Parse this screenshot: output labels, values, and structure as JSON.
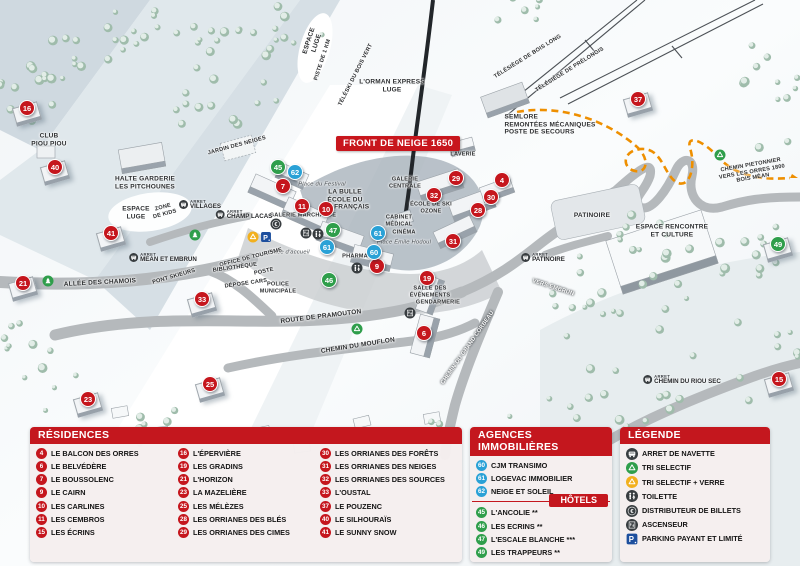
{
  "map": {
    "banner": "FRONT DE NEIGE 1650",
    "bus_prefix": "ARRET",
    "marker_colors": {
      "residence": "#c5161d",
      "hotel": "#2f9e4b",
      "agency": "#2aa1d6"
    },
    "markers": [
      {
        "n": 16,
        "type": "residence",
        "x": 27,
        "y": 108,
        "b": 1
      },
      {
        "n": 40,
        "type": "residence",
        "x": 55,
        "y": 167,
        "b": 1
      },
      {
        "n": 41,
        "type": "residence",
        "x": 111,
        "y": 233,
        "b": 1
      },
      {
        "n": 21,
        "type": "residence",
        "x": 23,
        "y": 283,
        "b": 1
      },
      {
        "n": 33,
        "type": "residence",
        "x": 202,
        "y": 299,
        "b": 1
      },
      {
        "n": 23,
        "type": "residence",
        "x": 88,
        "y": 399,
        "b": 1
      },
      {
        "n": 25,
        "type": "residence",
        "x": 210,
        "y": 384,
        "b": 1
      },
      {
        "n": 7,
        "type": "residence",
        "x": 283,
        "y": 186
      },
      {
        "n": 11,
        "type": "residence",
        "x": 302,
        "y": 206
      },
      {
        "n": 10,
        "type": "residence",
        "x": 326,
        "y": 209
      },
      {
        "n": 9,
        "type": "residence",
        "x": 377,
        "y": 266
      },
      {
        "n": 32,
        "type": "residence",
        "x": 434,
        "y": 195
      },
      {
        "n": 29,
        "type": "residence",
        "x": 456,
        "y": 178
      },
      {
        "n": 4,
        "type": "residence",
        "x": 502,
        "y": 180
      },
      {
        "n": 30,
        "type": "residence",
        "x": 491,
        "y": 197
      },
      {
        "n": 28,
        "type": "residence",
        "x": 478,
        "y": 210
      },
      {
        "n": 31,
        "type": "residence",
        "x": 453,
        "y": 241
      },
      {
        "n": 19,
        "type": "residence",
        "x": 427,
        "y": 278
      },
      {
        "n": 6,
        "type": "residence",
        "x": 424,
        "y": 333
      },
      {
        "n": 37,
        "type": "residence",
        "x": 638,
        "y": 99,
        "b": 1
      },
      {
        "n": 15,
        "type": "residence",
        "x": 779,
        "y": 379,
        "b": 1
      },
      {
        "n": 45,
        "type": "hotel",
        "x": 278,
        "y": 167
      },
      {
        "n": 46,
        "type": "hotel",
        "x": 329,
        "y": 280
      },
      {
        "n": 47,
        "type": "hotel",
        "x": 333,
        "y": 230
      },
      {
        "n": 49,
        "type": "hotel",
        "x": 778,
        "y": 244,
        "b": 1
      },
      {
        "n": 60,
        "type": "agency",
        "x": 374,
        "y": 252
      },
      {
        "n": 61,
        "type": "agency",
        "x": 378,
        "y": 233
      },
      {
        "n": 61,
        "type": "agency",
        "x": 327,
        "y": 247
      },
      {
        "n": 62,
        "type": "agency",
        "x": 295,
        "y": 172
      }
    ],
    "labels": [
      {
        "t": "ESPACE\nLUGE",
        "x": 313,
        "y": 42,
        "r": -72
      },
      {
        "t": "PISTE DE 1 KM",
        "x": 323,
        "y": 60,
        "r": -72,
        "cls": "micro"
      },
      {
        "t": "TÉLÉSKI DU BOIS VERT",
        "x": 356,
        "y": 75,
        "r": -63,
        "cls": "micro"
      },
      {
        "t": "L'ORMAN EXPRESS\nLUGE",
        "x": 392,
        "y": 86
      },
      {
        "t": "TÉLÉSIÈGE DE BOIS LONG",
        "x": 528,
        "y": 57,
        "r": -32,
        "cls": "micro"
      },
      {
        "t": "TÉLÉSIÈGE DE PRÉLONGIS",
        "x": 570,
        "y": 70,
        "r": -32,
        "cls": "micro"
      },
      {
        "t": "SEMLORE\nREMONTÉES MÉCANIQUES\nPOSTE DE SECOURS",
        "x": 550,
        "y": 125,
        "cls": "left"
      },
      {
        "t": "CLUB\nPIOU PIOU",
        "x": 49,
        "y": 140
      },
      {
        "t": "JARDIN DES NEIGES",
        "x": 237,
        "y": 146,
        "r": -15,
        "cls": "micro"
      },
      {
        "t": "HALTE GARDERIE\nLES PITCHOUNES",
        "x": 145,
        "y": 183
      },
      {
        "t": "ESPACE\nLUGE",
        "x": 136,
        "y": 213
      },
      {
        "t": "ZONE\nDE KIDS",
        "x": 164,
        "y": 211,
        "r": -15,
        "cls": "micro"
      },
      {
        "t": "ALLÉE DES CHAMOIS",
        "x": 100,
        "y": 283,
        "r": -3
      },
      {
        "t": "PONT SKIEURS",
        "x": 174,
        "y": 277,
        "r": -16,
        "cls": "micro"
      },
      {
        "t": "DÉPOSE CARS",
        "x": 246,
        "y": 284,
        "r": -8,
        "cls": "micro"
      },
      {
        "t": "ROUTE DE PRAMOUTON",
        "x": 321,
        "y": 317,
        "r": -7
      },
      {
        "t": "CHEMIN DU MOUFLON",
        "x": 358,
        "y": 346,
        "r": -9
      },
      {
        "t": "CHEMIN DU GRAND CORBEAU",
        "x": 468,
        "y": 348,
        "r": -55,
        "cls": "white micro"
      },
      {
        "t": "VERS EMBRUN",
        "x": 553,
        "y": 288,
        "r": 18,
        "cls": "white micro"
      },
      {
        "t": "CHEMIN PIETONNIER\nVERS LES ORRES 1800\nBOIS MÉAN",
        "x": 752,
        "y": 172,
        "r": -10,
        "cls": "micro"
      },
      {
        "t": "ESPACE RENCONTRE\nET CULTURE",
        "x": 672,
        "y": 231
      },
      {
        "t": "PATINOIRE",
        "x": 592,
        "y": 216
      },
      {
        "t": "LA BULLE\nÉCOLE DU\nSKI FRANÇAIS",
        "x": 345,
        "y": 200
      },
      {
        "t": "Place du Festival",
        "x": 322,
        "y": 185,
        "cls": "it"
      },
      {
        "t": "GALERIE MARCHANDE",
        "x": 303,
        "y": 216,
        "cls": "micro"
      },
      {
        "t": "GALERIE\nCENTRALE",
        "x": 405,
        "y": 183,
        "cls": "micro"
      },
      {
        "t": "LAVERIE",
        "x": 463,
        "y": 155,
        "cls": "micro"
      },
      {
        "t": "ÉCOLE DE SKI\nOZONE",
        "x": 431,
        "y": 208,
        "cls": "micro"
      },
      {
        "t": "CABINET\nMÉDICAL",
        "x": 399,
        "y": 221,
        "cls": "micro"
      },
      {
        "t": "CINÉMA",
        "x": 404,
        "y": 233,
        "cls": "micro"
      },
      {
        "t": "Place Émile Hodoul",
        "x": 404,
        "y": 243,
        "cls": "it"
      },
      {
        "t": "PHARMACIE",
        "x": 360,
        "y": 257,
        "cls": "micro"
      },
      {
        "t": "Place d'accueil",
        "x": 289,
        "y": 253,
        "cls": "it"
      },
      {
        "t": "OFFICE DE TOURISME",
        "x": 251,
        "y": 258,
        "r": -14,
        "cls": "micro"
      },
      {
        "t": "BIBLIOTHÈQUE",
        "x": 235,
        "y": 268,
        "r": -8,
        "cls": "micro"
      },
      {
        "t": "POSTE",
        "x": 264,
        "y": 272,
        "r": -12,
        "cls": "micro"
      },
      {
        "t": "POLICE\nMUNICIPALE",
        "x": 278,
        "y": 288,
        "cls": "micro"
      },
      {
        "t": "SALLE DES\nÉVÈNEMENTS",
        "x": 430,
        "y": 292,
        "cls": "micro"
      },
      {
        "t": "GENDARMERIE",
        "x": 438,
        "y": 303,
        "cls": "micro"
      }
    ],
    "bus_stops": [
      {
        "name": "VILLAGES",
        "x": 200,
        "y": 205
      },
      {
        "name": "CHAMP LACAS",
        "x": 244,
        "y": 215
      },
      {
        "name": "MEAN ET EMBRUN",
        "x": 163,
        "y": 258
      },
      {
        "name": "PATINOIRE",
        "x": 543,
        "y": 258
      },
      {
        "name": "CHEMIN DU RIOU SEC",
        "x": 682,
        "y": 380
      }
    ],
    "icons": [
      {
        "k": "tree",
        "x": 48,
        "y": 281
      },
      {
        "k": "tree",
        "x": 195,
        "y": 235
      },
      {
        "k": "recycle-green",
        "x": 357,
        "y": 329
      },
      {
        "k": "recycle-green",
        "x": 720,
        "y": 155
      },
      {
        "k": "recycle-yellow",
        "x": 253,
        "y": 237
      },
      {
        "k": "parking",
        "x": 266,
        "y": 237
      },
      {
        "k": "atm",
        "x": 276,
        "y": 224
      },
      {
        "k": "elevator",
        "x": 306,
        "y": 233
      },
      {
        "k": "toilet",
        "x": 318,
        "y": 234
      },
      {
        "k": "toilet",
        "x": 357,
        "y": 268
      },
      {
        "k": "elevator",
        "x": 410,
        "y": 313
      }
    ]
  },
  "legend": {
    "residences": {
      "title": "RÉSIDENCES",
      "columns": [
        [
          {
            "n": 4,
            "name": "LE BALCON DES ORRES"
          },
          {
            "n": 6,
            "name": "LE BELVÉDÈRE"
          },
          {
            "n": 7,
            "name": "LE BOUSSOLENC"
          },
          {
            "n": 9,
            "name": "LE CAIRN"
          },
          {
            "n": 10,
            "name": "LES CARLINES"
          },
          {
            "n": 11,
            "name": "LES CEMBROS"
          },
          {
            "n": 15,
            "name": "LES ÉCRINS"
          }
        ],
        [
          {
            "n": 16,
            "name": "L'ÉPERVIÈRE"
          },
          {
            "n": 19,
            "name": "LES GRADINS"
          },
          {
            "n": 21,
            "name": "L'HORIZON"
          },
          {
            "n": 23,
            "name": "LA MAZELIÈRE"
          },
          {
            "n": 25,
            "name": "LES MÉLÈZES"
          },
          {
            "n": 28,
            "name": "LES ORRIANES DES BLÉS"
          },
          {
            "n": 29,
            "name": "LES ORRIANES DES CIMES"
          }
        ],
        [
          {
            "n": 30,
            "name": "LES ORRIANES DES FORÊTS"
          },
          {
            "n": 31,
            "name": "LES ORRIANES DES NEIGES"
          },
          {
            "n": 32,
            "name": "LES ORRIANES DES SOURCES"
          },
          {
            "n": 33,
            "name": "L'OUSTAL"
          },
          {
            "n": 37,
            "name": "LE POUZENC"
          },
          {
            "n": 40,
            "name": "LE SILHOURAÏS"
          },
          {
            "n": 41,
            "name": "LE SUNNY SNOW"
          }
        ]
      ]
    },
    "agencies": {
      "title": "AGENCES IMMOBILIÈRES",
      "items": [
        {
          "n": 60,
          "name": "CJM TRANSIMO"
        },
        {
          "n": 61,
          "name": "LOGEVAC IMMOBILIER"
        },
        {
          "n": 62,
          "name": "NEIGE ET SOLEIL"
        }
      ]
    },
    "hotels": {
      "title": "HÔTELS",
      "items": [
        {
          "n": 45,
          "name": "L'ANCOLIE **"
        },
        {
          "n": 46,
          "name": "LES ECRINS **"
        },
        {
          "n": 47,
          "name": "L'ESCALE BLANCHE ***"
        },
        {
          "n": 49,
          "name": "LES TRAPPEURS **"
        }
      ]
    },
    "legende": {
      "title": "LÉGENDE",
      "items": [
        {
          "icon": "bus",
          "label": "ARRET DE NAVETTE"
        },
        {
          "icon": "recycle-green",
          "label": "TRI SELECTIF"
        },
        {
          "icon": "recycle-yellow",
          "label": "TRI SELECTIF + VERRE"
        },
        {
          "icon": "toilet",
          "label": "TOILETTE"
        },
        {
          "icon": "atm",
          "label": "DISTRIBUTEUR DE BILLETS"
        },
        {
          "icon": "elevator",
          "label": "ASCENSEUR"
        },
        {
          "icon": "parking",
          "label": "PARKING PAYANT ET LIMITÉ"
        }
      ]
    }
  }
}
